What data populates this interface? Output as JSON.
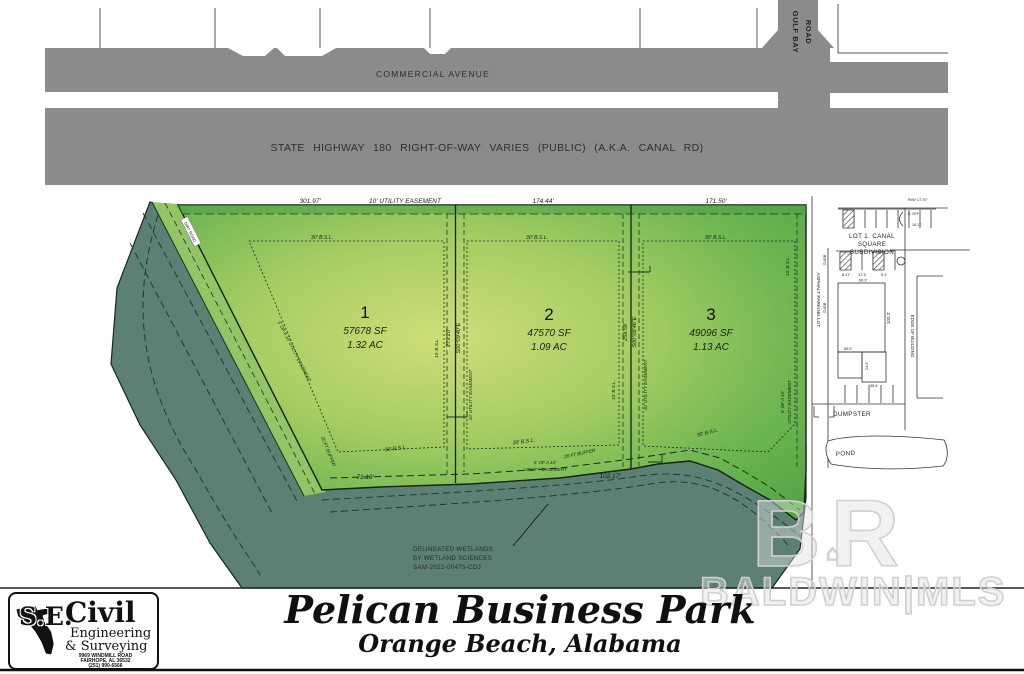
{
  "colors": {
    "road_gray": "#8b8b8b",
    "wetland_green": "#5c8074",
    "lot_green_center": "#cede79",
    "lot_green_edge": "#55a445"
  },
  "roads": {
    "commercial_avenue": "COMMERCIAL AVENUE",
    "state_highway": "STATE HIGHWAY 180 RIGHT-OF-WAY VARIES (PUBLIC) (A.K.A. CANAL RD)",
    "gulf_bay_line1": "GULF BAY",
    "gulf_bay_line2": "ROAD",
    "dirt_road": "DIRT ROAD"
  },
  "survey": {
    "top_dim_lot1": "301.97'",
    "top_easement": "10' UTILITY EASEMENT",
    "top_dim_lot2": "174.44'",
    "top_dim_lot3": "171.50'",
    "bsl_30": "30' B.S.L.",
    "bsl_10": "10' B.S.L.",
    "b12_dim": "279.28'",
    "b12_bearing": "S00°09'40\"E",
    "b12_easement": "10' UTILITY EASEMENT",
    "b23_dim": "259.58'",
    "b23_bearing": "S00°08'46\"E",
    "b23_easement": "10' UTILITY EASEMENT",
    "right_easement_l1": "5' OF A 10'",
    "right_easement_l2": "UTILITY EASEMENT",
    "diag_easement": "5' OF A 10' UTILITY EASEMENT",
    "bottom_dim1": "71.19'",
    "bottom_easement_l1": "5' OF A 10'",
    "bottom_easement_l2": "UTILITY EASEMENT",
    "bottom_dim2": "102.17'",
    "buffer": "20 FT BUFFER"
  },
  "lots": [
    {
      "number": "1",
      "sf": "57678 SF",
      "ac": "1.32 AC"
    },
    {
      "number": "2",
      "sf": "47570 SF",
      "ac": "1.09 AC"
    },
    {
      "number": "3",
      "sf": "49096 SF",
      "ac": "1.13 AC"
    }
  ],
  "east_parcel": {
    "subdivision_l1": "LOT 1. CANAL",
    "subdivision_l2": "SQUARE",
    "subdivision_l3": "SUBDIVISION",
    "asphalt_parking": "ASPHALT PARKING LOT",
    "curb": "CURB",
    "dumpster": "DUMPSTER",
    "pond": "POND",
    "edge_of_building": "EDGE OF BUILDING",
    "dim_rw": "R/W 17.97'",
    "dim_off": "8' OFF",
    "dim_1817": "18.17'",
    "dim_817": "8.17'",
    "dim_179": "17.9",
    "dim_91": "9.1'",
    "dim_603": "60.3'",
    "dim_300": "30.0'",
    "dim_249": "24.9'",
    "dim_304": "30.4'",
    "dim_1032": "103.2'"
  },
  "wetlands_note": {
    "line1": "DELINEATED WETLANDS",
    "line2": "BY WETLAND SCIENCES",
    "line3": "SAM-2022-00475-CDJ"
  },
  "title": {
    "main": "Pelican Business Park",
    "sub": "Orange Beach, Alabama"
  },
  "logo": {
    "se": "S.E.",
    "civil": "Civil",
    "line2": "Engineering",
    "line3": "& Surveying",
    "addr1": "9969 WINDMILL ROAD",
    "addr2": "FAIRHOPE, AL 36532",
    "phone": "(251) 990-6566"
  },
  "watermark": {
    "letters": "BR",
    "text": "BALDWIN|MLS"
  }
}
